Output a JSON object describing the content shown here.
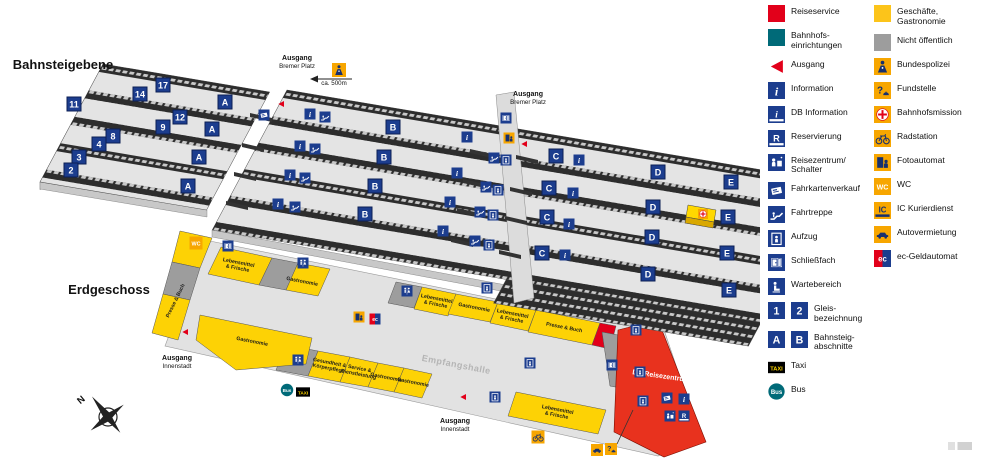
{
  "map": {
    "labels": [
      {
        "t": "Bahnsteigebene",
        "x": 63,
        "y": 67,
        "r": 0,
        "c": "lvl"
      },
      {
        "t": "Erdgeschoss",
        "x": 109,
        "y": 292,
        "r": 0,
        "c": "lvl"
      },
      {
        "t": "Ausgang",
        "x": 297,
        "y": 59,
        "r": 0,
        "c": "exb"
      },
      {
        "t": "Bremer Platz",
        "x": 297,
        "y": 67,
        "r": 0,
        "c": "exs"
      },
      {
        "t": "ca. 500m",
        "x": 334,
        "y": 84,
        "r": 0,
        "c": "scale"
      },
      {
        "t": "Ausgang",
        "x": 528,
        "y": 95,
        "r": 0,
        "c": "exb"
      },
      {
        "t": "Bremer Platz",
        "x": 528,
        "y": 103,
        "r": 0,
        "c": "exs"
      },
      {
        "t": "Ausgang",
        "x": 177,
        "y": 359,
        "r": 0,
        "c": "exb"
      },
      {
        "t": "Innenstadt",
        "x": 177,
        "y": 367,
        "r": 0,
        "c": "exs"
      },
      {
        "t": "Ausgang",
        "x": 455,
        "y": 422,
        "r": 0,
        "c": "exb"
      },
      {
        "t": "Innenstadt",
        "x": 455,
        "y": 430,
        "r": 0,
        "c": "exs"
      },
      {
        "t": "Empfangshalle",
        "x": 456,
        "y": 366,
        "r": 11,
        "c": "hall"
      },
      {
        "t": "DB Reisezentrum",
        "x": 661,
        "y": 377,
        "r": 8,
        "c": "db"
      },
      {
        "t": "Lebensmittel\n& Frische",
        "x": 238,
        "y": 266,
        "r": 11,
        "c": "shop"
      },
      {
        "t": "Gastronomie",
        "x": 302,
        "y": 282,
        "r": 11,
        "c": "shop"
      },
      {
        "t": "Lebensmittel\n& Frische",
        "x": 436,
        "y": 302,
        "r": 11,
        "c": "shop"
      },
      {
        "t": "Gastronomie",
        "x": 474,
        "y": 308,
        "r": 11,
        "c": "shop"
      },
      {
        "t": "Lebensmittel\n& Frische",
        "x": 512,
        "y": 317,
        "r": 11,
        "c": "shop"
      },
      {
        "t": "Presse & Buch",
        "x": 564,
        "y": 328,
        "r": 11,
        "c": "shop"
      },
      {
        "t": "Lebensmittel\n& Frische",
        "x": 557,
        "y": 413,
        "r": 11,
        "c": "shop"
      },
      {
        "t": "Gastronomie",
        "x": 252,
        "y": 342,
        "r": 11,
        "c": "shop"
      },
      {
        "t": "Gesundheit &\nKörperpflege",
        "x": 329,
        "y": 366,
        "r": 11,
        "c": "shop"
      },
      {
        "t": "Service &\nDienstleistung",
        "x": 359,
        "y": 372,
        "r": 11,
        "c": "shop"
      },
      {
        "t": "Gastronomie",
        "x": 386,
        "y": 378,
        "r": 11,
        "c": "shop"
      },
      {
        "t": "Gastronomie",
        "x": 413,
        "y": 383,
        "r": 11,
        "c": "shop"
      },
      {
        "t": "Presse & Buch",
        "x": 176,
        "y": 301,
        "r": -64,
        "c": "shop"
      },
      {
        "t": "N",
        "x": 82,
        "y": 401,
        "r": -40,
        "c": "north"
      }
    ],
    "badges": [
      {
        "t": "17",
        "x": 163,
        "y": 85
      },
      {
        "t": "14",
        "x": 140,
        "y": 94
      },
      {
        "t": "12",
        "x": 180,
        "y": 117
      },
      {
        "t": "11",
        "x": 74,
        "y": 104
      },
      {
        "t": "9",
        "x": 163,
        "y": 127
      },
      {
        "t": "8",
        "x": 113,
        "y": 136
      },
      {
        "t": "4",
        "x": 99,
        "y": 144
      },
      {
        "t": "3",
        "x": 79,
        "y": 157
      },
      {
        "t": "2",
        "x": 71,
        "y": 170
      },
      {
        "t": "A",
        "x": 225,
        "y": 102
      },
      {
        "t": "A",
        "x": 212,
        "y": 129
      },
      {
        "t": "A",
        "x": 199,
        "y": 157
      },
      {
        "t": "A",
        "x": 188,
        "y": 186
      },
      {
        "t": "B",
        "x": 393,
        "y": 127
      },
      {
        "t": "B",
        "x": 384,
        "y": 157
      },
      {
        "t": "B",
        "x": 375,
        "y": 186
      },
      {
        "t": "B",
        "x": 365,
        "y": 214
      },
      {
        "t": "C",
        "x": 556,
        "y": 156
      },
      {
        "t": "C",
        "x": 549,
        "y": 188
      },
      {
        "t": "C",
        "x": 547,
        "y": 217
      },
      {
        "t": "C",
        "x": 542,
        "y": 253
      },
      {
        "t": "D",
        "x": 658,
        "y": 172
      },
      {
        "t": "D",
        "x": 653,
        "y": 207
      },
      {
        "t": "D",
        "x": 652,
        "y": 237
      },
      {
        "t": "D",
        "x": 648,
        "y": 274
      },
      {
        "t": "E",
        "x": 731,
        "y": 182
      },
      {
        "t": "E",
        "x": 728,
        "y": 217
      },
      {
        "t": "E",
        "x": 727,
        "y": 253
      },
      {
        "t": "E",
        "x": 729,
        "y": 290
      }
    ],
    "icons": [
      {
        "k": "info",
        "x": 310,
        "y": 114
      },
      {
        "k": "info",
        "x": 300,
        "y": 146
      },
      {
        "k": "info",
        "x": 290,
        "y": 175
      },
      {
        "k": "info",
        "x": 278,
        "y": 204
      },
      {
        "k": "info",
        "x": 467,
        "y": 137
      },
      {
        "k": "info",
        "x": 457,
        "y": 173
      },
      {
        "k": "info",
        "x": 450,
        "y": 202
      },
      {
        "k": "info",
        "x": 443,
        "y": 231
      },
      {
        "k": "info",
        "x": 579,
        "y": 160
      },
      {
        "k": "info",
        "x": 573,
        "y": 193
      },
      {
        "k": "info",
        "x": 569,
        "y": 224
      },
      {
        "k": "info",
        "x": 565,
        "y": 255
      },
      {
        "k": "info",
        "x": 684,
        "y": 399
      },
      {
        "k": "fahrtreppe",
        "x": 325,
        "y": 117
      },
      {
        "k": "fahrtreppe",
        "x": 315,
        "y": 149
      },
      {
        "k": "fahrtreppe",
        "x": 305,
        "y": 178
      },
      {
        "k": "fahrtreppe",
        "x": 295,
        "y": 207
      },
      {
        "k": "fahrtreppe",
        "x": 494,
        "y": 158
      },
      {
        "k": "fahrtreppe",
        "x": 486,
        "y": 187
      },
      {
        "k": "fahrtreppe",
        "x": 480,
        "y": 212
      },
      {
        "k": "fahrtreppe",
        "x": 475,
        "y": 241
      },
      {
        "k": "aufzug",
        "x": 506,
        "y": 160
      },
      {
        "k": "aufzug",
        "x": 498,
        "y": 190
      },
      {
        "k": "aufzug",
        "x": 493,
        "y": 215
      },
      {
        "k": "aufzug",
        "x": 489,
        "y": 245
      },
      {
        "k": "aufzug",
        "x": 487,
        "y": 288
      },
      {
        "k": "aufzug",
        "x": 530,
        "y": 363
      },
      {
        "k": "aufzug",
        "x": 495,
        "y": 397
      },
      {
        "k": "aufzug",
        "x": 636,
        "y": 330
      },
      {
        "k": "aufzug",
        "x": 640,
        "y": 372
      },
      {
        "k": "aufzug",
        "x": 643,
        "y": 401
      },
      {
        "k": "fahrkarten",
        "x": 264,
        "y": 115
      },
      {
        "k": "fahrkarten",
        "x": 667,
        "y": 398
      },
      {
        "k": "schliessfach",
        "x": 506,
        "y": 118
      },
      {
        "k": "schliessfach",
        "x": 228,
        "y": 246
      },
      {
        "k": "schliessfach",
        "x": 612,
        "y": 365
      },
      {
        "k": "fotoautomat",
        "x": 509,
        "y": 138
      },
      {
        "k": "fotoautomat",
        "x": 359,
        "y": 317
      },
      {
        "k": "ec",
        "x": 375,
        "y": 319
      },
      {
        "k": "wc-orange",
        "x": 196,
        "y": 243,
        "s": 13
      },
      {
        "k": "wc-blue",
        "x": 303,
        "y": 263
      },
      {
        "k": "wc-blue",
        "x": 407,
        "y": 291
      },
      {
        "k": "wc-blue",
        "x": 298,
        "y": 360
      },
      {
        "k": "bahnhofsmission",
        "x": 703,
        "y": 214,
        "s": 10
      },
      {
        "k": "bundespolizei",
        "x": 339,
        "y": 70,
        "s": 14
      },
      {
        "k": "radstation",
        "x": 538,
        "y": 437,
        "s": 13
      },
      {
        "k": "autovermietung",
        "x": 597,
        "y": 450,
        "s": 12
      },
      {
        "k": "fundstelle",
        "x": 611,
        "y": 449,
        "s": 12
      },
      {
        "k": "bus",
        "x": 287,
        "y": 390,
        "s": 13
      },
      {
        "k": "taxi",
        "x": 303,
        "y": 392,
        "s": 14
      },
      {
        "k": "reisezentrum",
        "x": 670,
        "y": 416
      },
      {
        "k": "reservierung",
        "x": 684,
        "y": 416
      },
      {
        "k": "ausgang",
        "x": 281,
        "y": 104,
        "s": 8
      },
      {
        "k": "ausgang",
        "x": 524,
        "y": 144,
        "s": 8
      },
      {
        "k": "ausgang",
        "x": 185,
        "y": 332,
        "s": 8
      },
      {
        "k": "ausgang",
        "x": 463,
        "y": 397,
        "s": 8
      }
    ]
  },
  "legend": {
    "left": [
      {
        "icon": "sq-red",
        "label": "Reiseservice"
      },
      {
        "icon": "sq-teal",
        "label": "Bahnhofs-\neinrichtungen"
      },
      {
        "icon": "ausgang",
        "label": "Ausgang"
      },
      {
        "icon": "info",
        "label": "Information"
      },
      {
        "icon": "dbinfo",
        "label": "DB Information"
      },
      {
        "icon": "reservierung",
        "label": "Reservierung"
      },
      {
        "icon": "reisezentrum",
        "label": "Reisezentrum/\nSchalter"
      },
      {
        "icon": "fahrkarten",
        "label": "Fahrkartenverkauf"
      },
      {
        "icon": "fahrtreppe",
        "label": "Fahrtreppe"
      },
      {
        "icon": "aufzug",
        "label": "Aufzug"
      },
      {
        "icon": "schliessfach",
        "label": "Schließfach"
      },
      {
        "icon": "wartebereich",
        "label": "Wartebereich"
      },
      {
        "icon": "g1",
        "icon2": "g2",
        "label": "Gleis-\nbezeichnung"
      },
      {
        "icon": "gA",
        "icon2": "gB",
        "label": "Bahnsteig-\nabschnitte"
      },
      {
        "icon": "taxi",
        "label": "Taxi"
      },
      {
        "icon": "bus",
        "label": "Bus"
      }
    ],
    "right": [
      {
        "icon": "sq-yellow",
        "label": "Geschäfte,\nGastronomie"
      },
      {
        "icon": "sq-gray",
        "label": "Nicht öffentlich"
      },
      {
        "icon": "bundespolizei",
        "label": "Bundespolizei"
      },
      {
        "icon": "fundstelle",
        "label": "Fundstelle"
      },
      {
        "icon": "bahnhofsmission",
        "label": "Bahnhofsmission"
      },
      {
        "icon": "radstation",
        "label": "Radstation"
      },
      {
        "icon": "fotoautomat",
        "label": "Fotoautomat"
      },
      {
        "icon": "wc-orange",
        "label": "WC"
      },
      {
        "icon": "ic",
        "label": "IC Kurierdienst"
      },
      {
        "icon": "autovermietung",
        "label": "Autovermietung"
      },
      {
        "icon": "ec",
        "label": "ec-Geldautomat"
      }
    ]
  },
  "icon_glyphs": {
    "info": "i",
    "reservierung": "R",
    "track1": "1",
    "track2": "2",
    "sectionA": "A",
    "sectionB": "B",
    "taxi": "TAXI",
    "bus": "Bus",
    "question": "?",
    "wc": "WC",
    "ic": "IC",
    "ec": "ec"
  },
  "colors": {
    "navy": "#1c3d8e",
    "red": "#e2001a",
    "teal": "#006a78",
    "orange": "#f7a600",
    "yellow": "#fdd205",
    "gray_private": "#9d9d9d",
    "platform": "#e4e4e4"
  }
}
